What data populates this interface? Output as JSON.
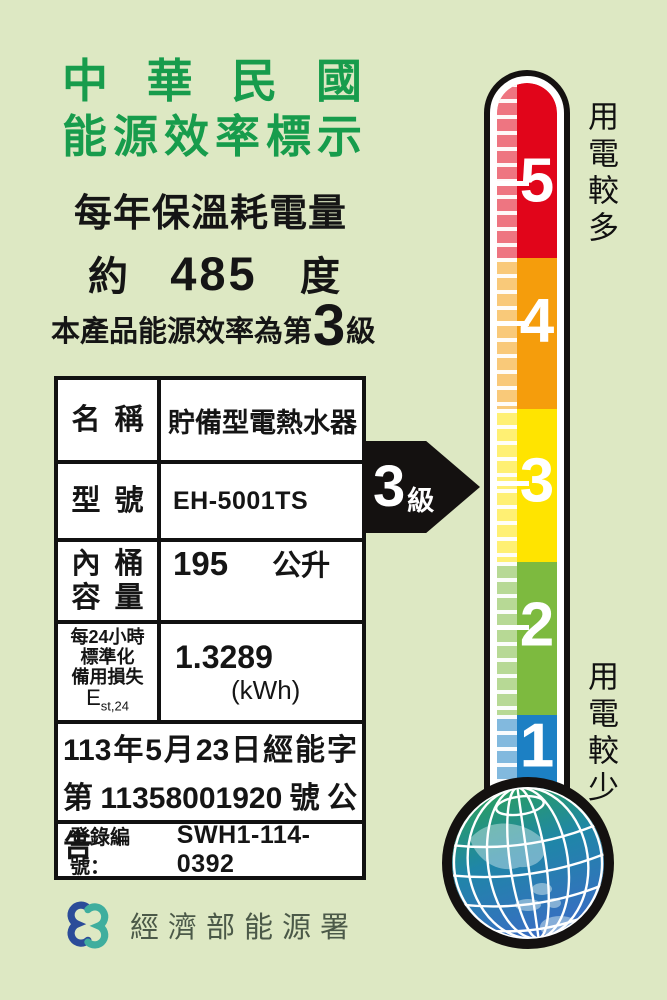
{
  "header": {
    "country_title": "中華民國",
    "label_title": "能源效率標示",
    "metric_title": "每年保溫耗電量",
    "approx_prefix": "約",
    "annual_consumption": "485",
    "consumption_unit": "度",
    "rating_prefix": "本產品能源效率為第",
    "rating_grade": "3",
    "rating_suffix": "級"
  },
  "spec_table": {
    "rows": [
      {
        "label": "名稱",
        "value": "貯備型電熱水器"
      },
      {
        "label": "型號",
        "value": "EH-5001TS"
      },
      {
        "label_line1": "內桶",
        "label_line2": "容量",
        "value": "195",
        "unit": "公升"
      },
      {
        "label_line1": "每24小時",
        "label_line2": "標準化",
        "label_line3": "備用損失",
        "symbol": "E",
        "symbol_sub": "st,24",
        "value": "1.3289",
        "unit": "(kWh)"
      }
    ],
    "announcement_line1": "113年5月23日經能字",
    "announcement_line2": "第11358001920號公告",
    "registration_label": "登錄編號：",
    "registration_number": "SWH1-114-0392"
  },
  "thermometer": {
    "arrow_grade": "3",
    "arrow_suffix": "級",
    "label_top": "用電較多",
    "label_bottom": "用電較少",
    "levels": [
      {
        "grade": "5",
        "color": "#e1051a"
      },
      {
        "grade": "4",
        "color": "#f59d0c"
      },
      {
        "grade": "3",
        "color": "#ffe400"
      },
      {
        "grade": "2",
        "color": "#7dba3f"
      },
      {
        "grade": "1",
        "color": "#1c80c4"
      }
    ]
  },
  "footer": {
    "agency": "經濟部能源署"
  },
  "colors": {
    "background": "#dde8c3",
    "title_green": "#179c4c",
    "outline_black": "#141110",
    "logo_blue": "#2b4c99",
    "logo_teal": "#3fae9e"
  }
}
